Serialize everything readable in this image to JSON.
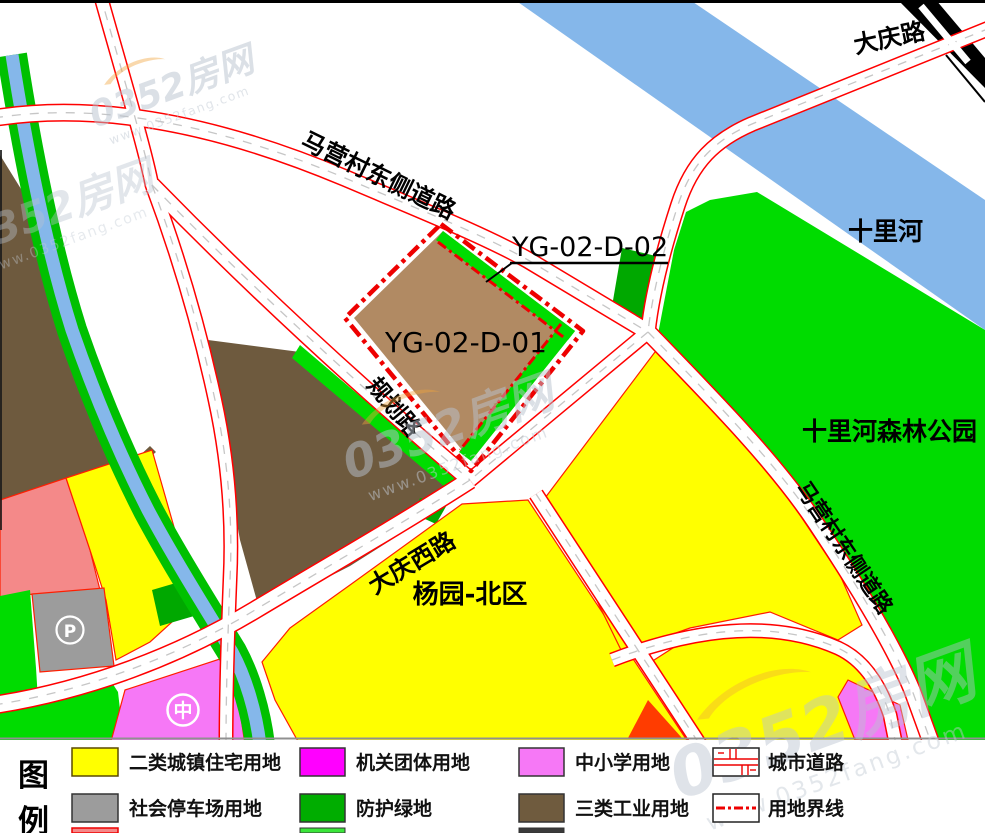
{
  "map": {
    "plots": {
      "main": "YG-02-D-01",
      "green": "YG-02-D-02"
    },
    "roads": {
      "maying_north": "马营村东侧道路",
      "maying_east": "马营村东侧道路",
      "daqing": "大庆路",
      "daqing_west": "大庆西路",
      "planning": "规划路"
    },
    "areas": {
      "river": "十里河",
      "forest_park": "十里河森林公园",
      "district": "杨园-北区"
    },
    "symbols": {
      "parking": "P",
      "school": "中"
    }
  },
  "watermark": {
    "brand": "0352房网",
    "url": "www.0352fang.com"
  },
  "legend": {
    "title": [
      "图",
      "例"
    ],
    "rows": [
      [
        {
          "label": "二类城镇住宅用地",
          "color": "#ffff00"
        },
        {
          "label": "机关团体用地",
          "color": "#ff00ff"
        },
        {
          "label": "中小学用地",
          "color": "#f678f6"
        },
        {
          "label": "城市道路",
          "type": "road-pattern"
        }
      ],
      [
        {
          "label": "社会停车场用地",
          "color": "#9c9c9c"
        },
        {
          "label": "防护绿地",
          "color": "#00ad00"
        },
        {
          "label": "三类工业用地",
          "color": "#6f5b3e"
        },
        {
          "label": "用地界线",
          "type": "boundary-line"
        }
      ]
    ],
    "partial_row_colors": [
      "#f48989",
      "#3ae63a",
      "#3a3a3a"
    ]
  },
  "palette": {
    "yellow": "#ffff00",
    "green": "#00dc00",
    "green_dark": "#00a800",
    "green_flank": "#00c000",
    "blue": "#85b7ea",
    "salmon": "#f48989",
    "gray": "#9c9c9c",
    "pink": "#f678f6",
    "brown_dark": "#6e5a3e",
    "brown_light": "#b18a63",
    "orange": "#ff3c00",
    "red_line": "#ff0000",
    "boundary_red": "#ee0000",
    "black": "#000000"
  }
}
